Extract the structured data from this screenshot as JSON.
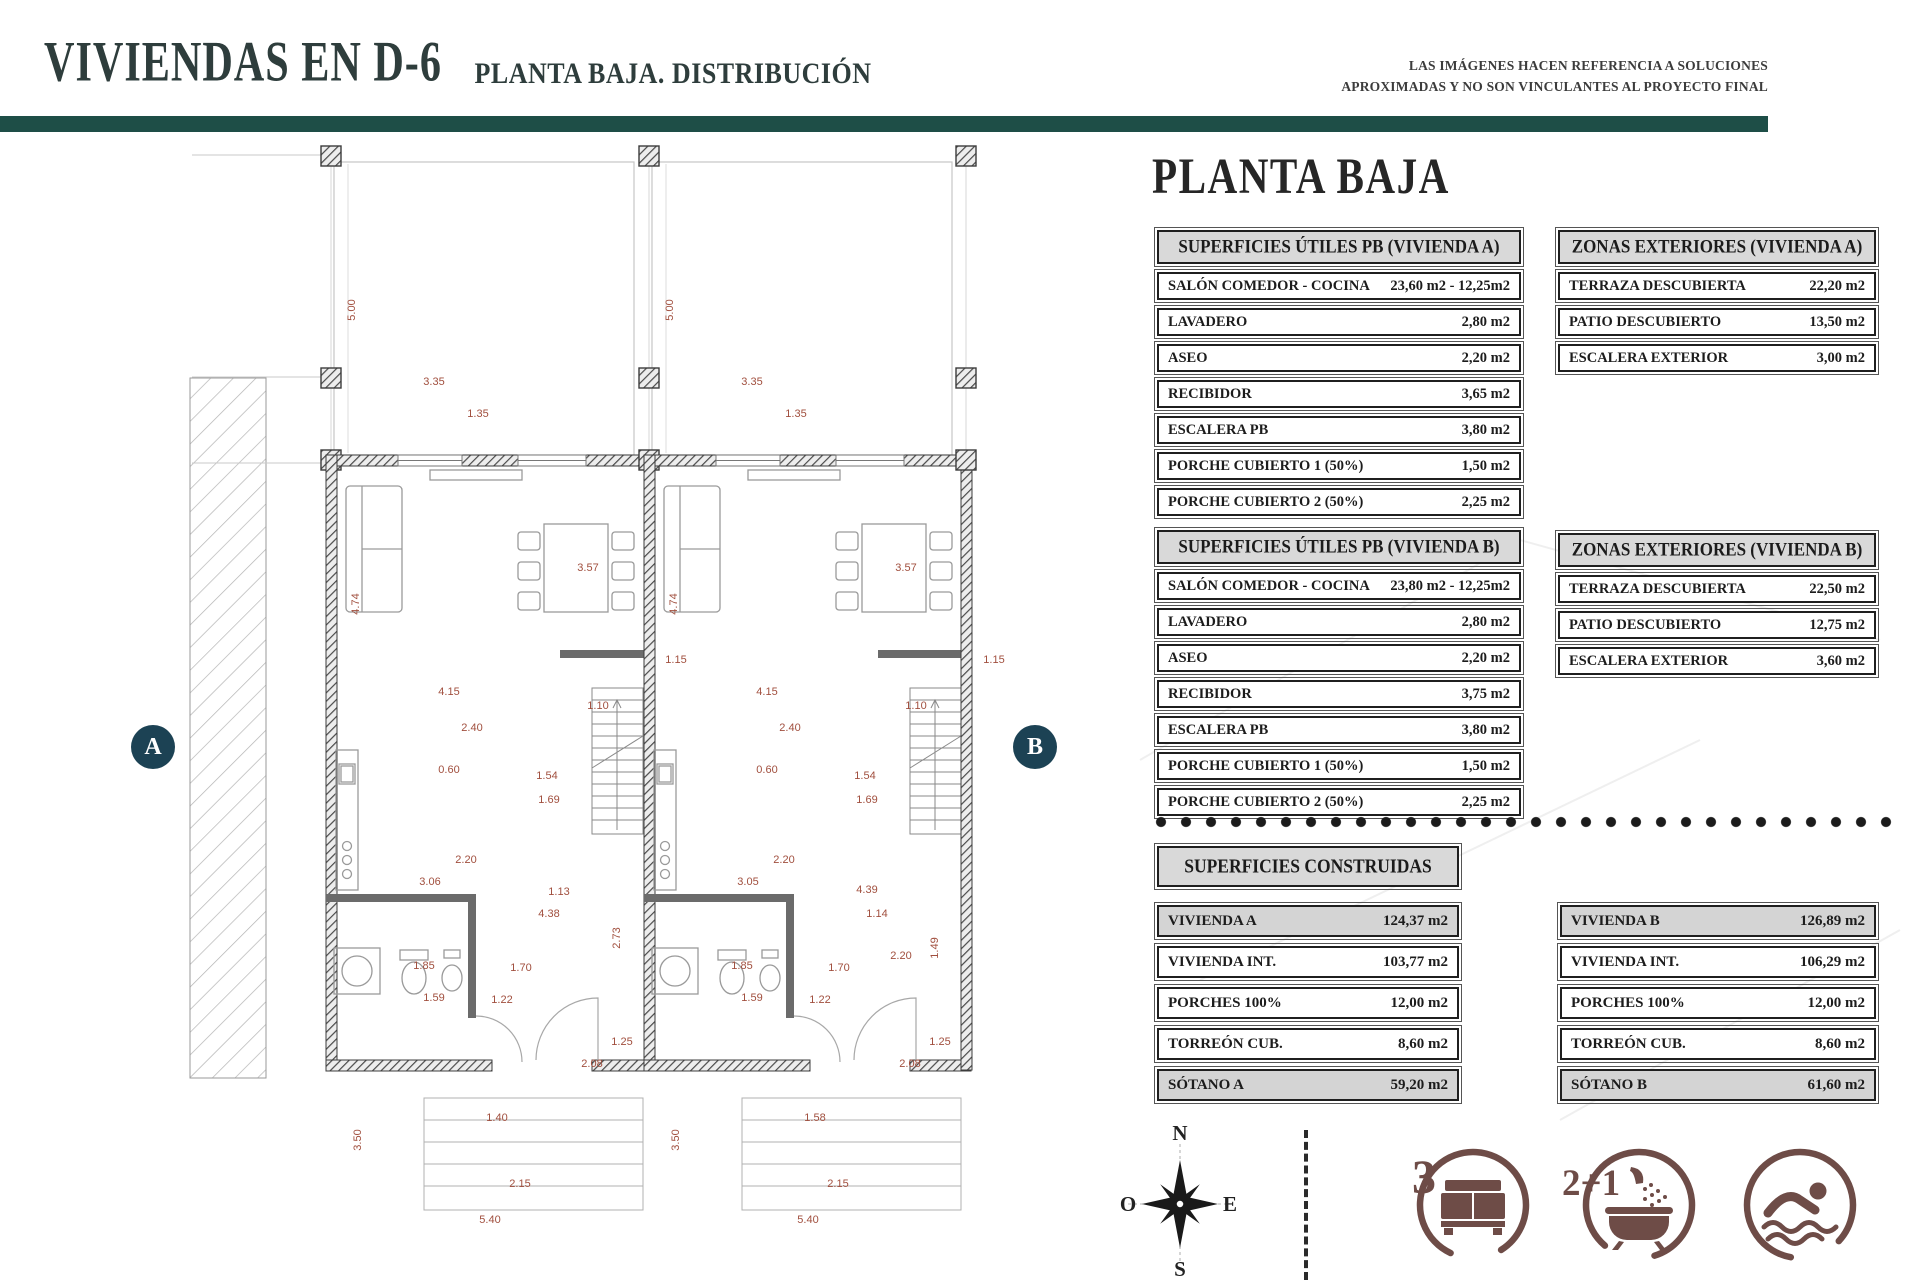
{
  "header": {
    "title": "VIVIENDAS EN D-6",
    "subtitle": "PLANTA BAJA. DISTRIBUCIÓN",
    "disclaimer_line1": "LAS IMÁGENES HACEN REFERENCIA A SOLUCIONES",
    "disclaimer_line2": "APROXIMADAS Y NO SON VINCULANTES AL PROYECTO FINAL"
  },
  "panel": {
    "heading": "PLANTA BAJA",
    "utiles_a": {
      "title": "SUPERFICIES ÚTILES PB (VIVIENDA A)",
      "rows": [
        {
          "label": "SALÓN COMEDOR - COCINA",
          "value": "23,60 m2 - 12,25m2"
        },
        {
          "label": "LAVADERO",
          "value": "2,80 m2"
        },
        {
          "label": "ASEO",
          "value": "2,20 m2"
        },
        {
          "label": "RECIBIDOR",
          "value": "3,65 m2"
        },
        {
          "label": "ESCALERA PB",
          "value": "3,80 m2"
        },
        {
          "label": "PORCHE CUBIERTO 1 (50%)",
          "value": "1,50 m2"
        },
        {
          "label": "PORCHE CUBIERTO 2 (50%)",
          "value": "2,25 m2"
        }
      ]
    },
    "ext_a": {
      "title": "ZONAS EXTERIORES (VIVIENDA A)",
      "rows": [
        {
          "label": "TERRAZA DESCUBIERTA",
          "value": "22,20 m2"
        },
        {
          "label": "PATIO DESCUBIERTO",
          "value": "13,50 m2"
        },
        {
          "label": "ESCALERA EXTERIOR",
          "value": "3,00 m2"
        }
      ]
    },
    "utiles_b": {
      "title": "SUPERFICIES ÚTILES PB (VIVIENDA B)",
      "rows": [
        {
          "label": "SALÓN COMEDOR - COCINA",
          "value": "23,80 m2 - 12,25m2"
        },
        {
          "label": "LAVADERO",
          "value": "2,80 m2"
        },
        {
          "label": "ASEO",
          "value": "2,20 m2"
        },
        {
          "label": "RECIBIDOR",
          "value": "3,75 m2"
        },
        {
          "label": "ESCALERA PB",
          "value": "3,80 m2"
        },
        {
          "label": "PORCHE CUBIERTO 1 (50%)",
          "value": "1,50 m2"
        },
        {
          "label": "PORCHE CUBIERTO 2 (50%)",
          "value": "2,25 m2"
        }
      ]
    },
    "ext_b": {
      "title": "ZONAS EXTERIORES (VIVIENDA B)",
      "rows": [
        {
          "label": "TERRAZA DESCUBIERTA",
          "value": "22,50 m2"
        },
        {
          "label": "PATIO DESCUBIERTO",
          "value": "12,75 m2"
        },
        {
          "label": "ESCALERA EXTERIOR",
          "value": "3,60 m2"
        }
      ]
    },
    "construidas": {
      "title": "SUPERFICIES CONSTRUIDAS",
      "left": [
        {
          "label": "VIVIENDA A",
          "value": "124,37 m2"
        },
        {
          "label": "VIVIENDA INT.",
          "value": "103,77 m2"
        },
        {
          "label": "PORCHES 100%",
          "value": "12,00 m2"
        },
        {
          "label": "TORREÓN CUB.",
          "value": "8,60 m2"
        },
        {
          "label": "SÓTANO A",
          "value": "59,20 m2"
        }
      ],
      "right": [
        {
          "label": "VIVIENDA B",
          "value": "126,89 m2"
        },
        {
          "label": "VIVIENDA INT.",
          "value": "106,29 m2"
        },
        {
          "label": "PORCHES 100%",
          "value": "12,00 m2"
        },
        {
          "label": "TORREÓN CUB.",
          "value": "8,60 m2"
        },
        {
          "label": "SÓTANO B",
          "value": "61,60 m2"
        }
      ]
    }
  },
  "plan": {
    "label_a": "A",
    "label_b": "B",
    "dimensions": [
      [
        352,
        310,
        "5.00",
        1
      ],
      [
        434,
        382,
        "3.35",
        0
      ],
      [
        478,
        414,
        "1.35",
        0
      ],
      [
        356,
        604,
        "4.74",
        1
      ],
      [
        588,
        568,
        "3.57",
        0
      ],
      [
        676,
        660,
        "1.15",
        0
      ],
      [
        449,
        692,
        "4.15",
        0
      ],
      [
        598,
        706,
        "1.10",
        0
      ],
      [
        472,
        728,
        "2.40",
        0
      ],
      [
        449,
        770,
        "0.60",
        0
      ],
      [
        547,
        776,
        "1.54",
        0
      ],
      [
        549,
        800,
        "1.69",
        0
      ],
      [
        466,
        860,
        "2.20",
        0
      ],
      [
        430,
        882,
        "3.06",
        0
      ],
      [
        559,
        892,
        "1.13",
        0
      ],
      [
        549,
        914,
        "4.38",
        0
      ],
      [
        617,
        938,
        "2.73",
        1
      ],
      [
        424,
        966,
        "1.85",
        0
      ],
      [
        521,
        968,
        "1.70",
        0
      ],
      [
        434,
        998,
        "1.59",
        0
      ],
      [
        502,
        1000,
        "1.22",
        0
      ],
      [
        622,
        1042,
        "1.25",
        0
      ],
      [
        592,
        1064,
        "2.08",
        0
      ],
      [
        497,
        1118,
        "1.40",
        0
      ],
      [
        358,
        1140,
        "3.50",
        1
      ],
      [
        520,
        1184,
        "2.15",
        0
      ],
      [
        490,
        1220,
        "5.40",
        0
      ],
      [
        670,
        310,
        "5.00",
        1
      ],
      [
        752,
        382,
        "3.35",
        0
      ],
      [
        796,
        414,
        "1.35",
        0
      ],
      [
        674,
        604,
        "4.74",
        1
      ],
      [
        906,
        568,
        "3.57",
        0
      ],
      [
        994,
        660,
        "1.15",
        0
      ],
      [
        767,
        692,
        "4.15",
        0
      ],
      [
        916,
        706,
        "1.10",
        0
      ],
      [
        790,
        728,
        "2.40",
        0
      ],
      [
        767,
        770,
        "0.60",
        0
      ],
      [
        865,
        776,
        "1.54",
        0
      ],
      [
        867,
        800,
        "1.69",
        0
      ],
      [
        784,
        860,
        "2.20",
        0
      ],
      [
        748,
        882,
        "3.05",
        0
      ],
      [
        867,
        890,
        "4.39",
        0
      ],
      [
        877,
        914,
        "1.14",
        0
      ],
      [
        901,
        956,
        "2.20",
        0
      ],
      [
        935,
        948,
        "1.49",
        1
      ],
      [
        742,
        966,
        "1.85",
        0
      ],
      [
        839,
        968,
        "1.70",
        0
      ],
      [
        752,
        998,
        "1.59",
        0
      ],
      [
        820,
        1000,
        "1.22",
        0
      ],
      [
        940,
        1042,
        "1.25",
        0
      ],
      [
        910,
        1064,
        "2.08",
        0
      ],
      [
        815,
        1118,
        "1.58",
        0
      ],
      [
        676,
        1140,
        "3.50",
        1
      ],
      [
        838,
        1184,
        "2.15",
        0
      ],
      [
        808,
        1220,
        "5.40",
        0
      ]
    ]
  },
  "compass": {
    "n": "N",
    "e": "E",
    "s": "S",
    "o": "O"
  },
  "features": {
    "bedrooms": "3",
    "bathrooms": "2+1"
  },
  "colors": {
    "teal_bar": "#1e4e47",
    "badge_navy": "#1c4254",
    "icon_brown": "#6e4c47",
    "dimension_text": "#a14f3e",
    "table_header_gray": "#d9d9d9"
  }
}
